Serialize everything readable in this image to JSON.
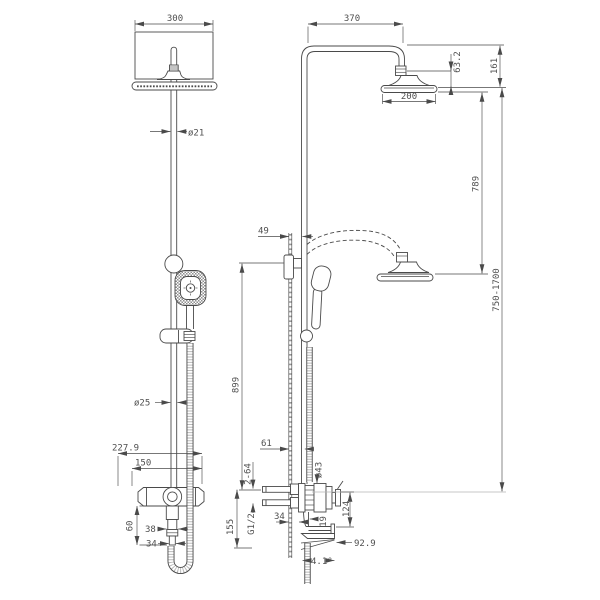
{
  "drawing": {
    "type": "technical-dimensional-drawing",
    "subject": "thermostatic shower column with overhead shower, hand shower and spout (front and side views)",
    "colors": {
      "background": "#ffffff",
      "line": "#4a4a4a",
      "light_line": "#b5b5b5",
      "text": "#4f4f4f"
    },
    "front_view": {
      "dim_head_width": "300",
      "dim_pipe_dia": "ø21",
      "dim_column_dia": "ø25",
      "dim_mixer_width": "227.9",
      "dim_inlet_spacing": "150",
      "dim_handle_drop": "60",
      "dim_stem_width": "38",
      "dim_nut_width": "34"
    },
    "side_view": {
      "dim_arm_length": "370",
      "dim_head_drop": "63.2",
      "dim_head_zone": "161",
      "dim_head_dia": "200",
      "dim_head_travel": "789",
      "dim_height_range": "750-1700",
      "dim_wall_offset": "49",
      "dim_bar_length": "899",
      "dim_column_offset": "61",
      "dim_eccentric": "2-64",
      "thread_label": "G1/2",
      "dim_outlet_drop": "155",
      "dim_wall_gap": "34",
      "dim_body_dia": "ø43",
      "dim_spout_drop": "124",
      "dim_spout_gap": "19",
      "dim_spout_reach": "92.9",
      "dim_spout_angle": "4.1°"
    }
  }
}
